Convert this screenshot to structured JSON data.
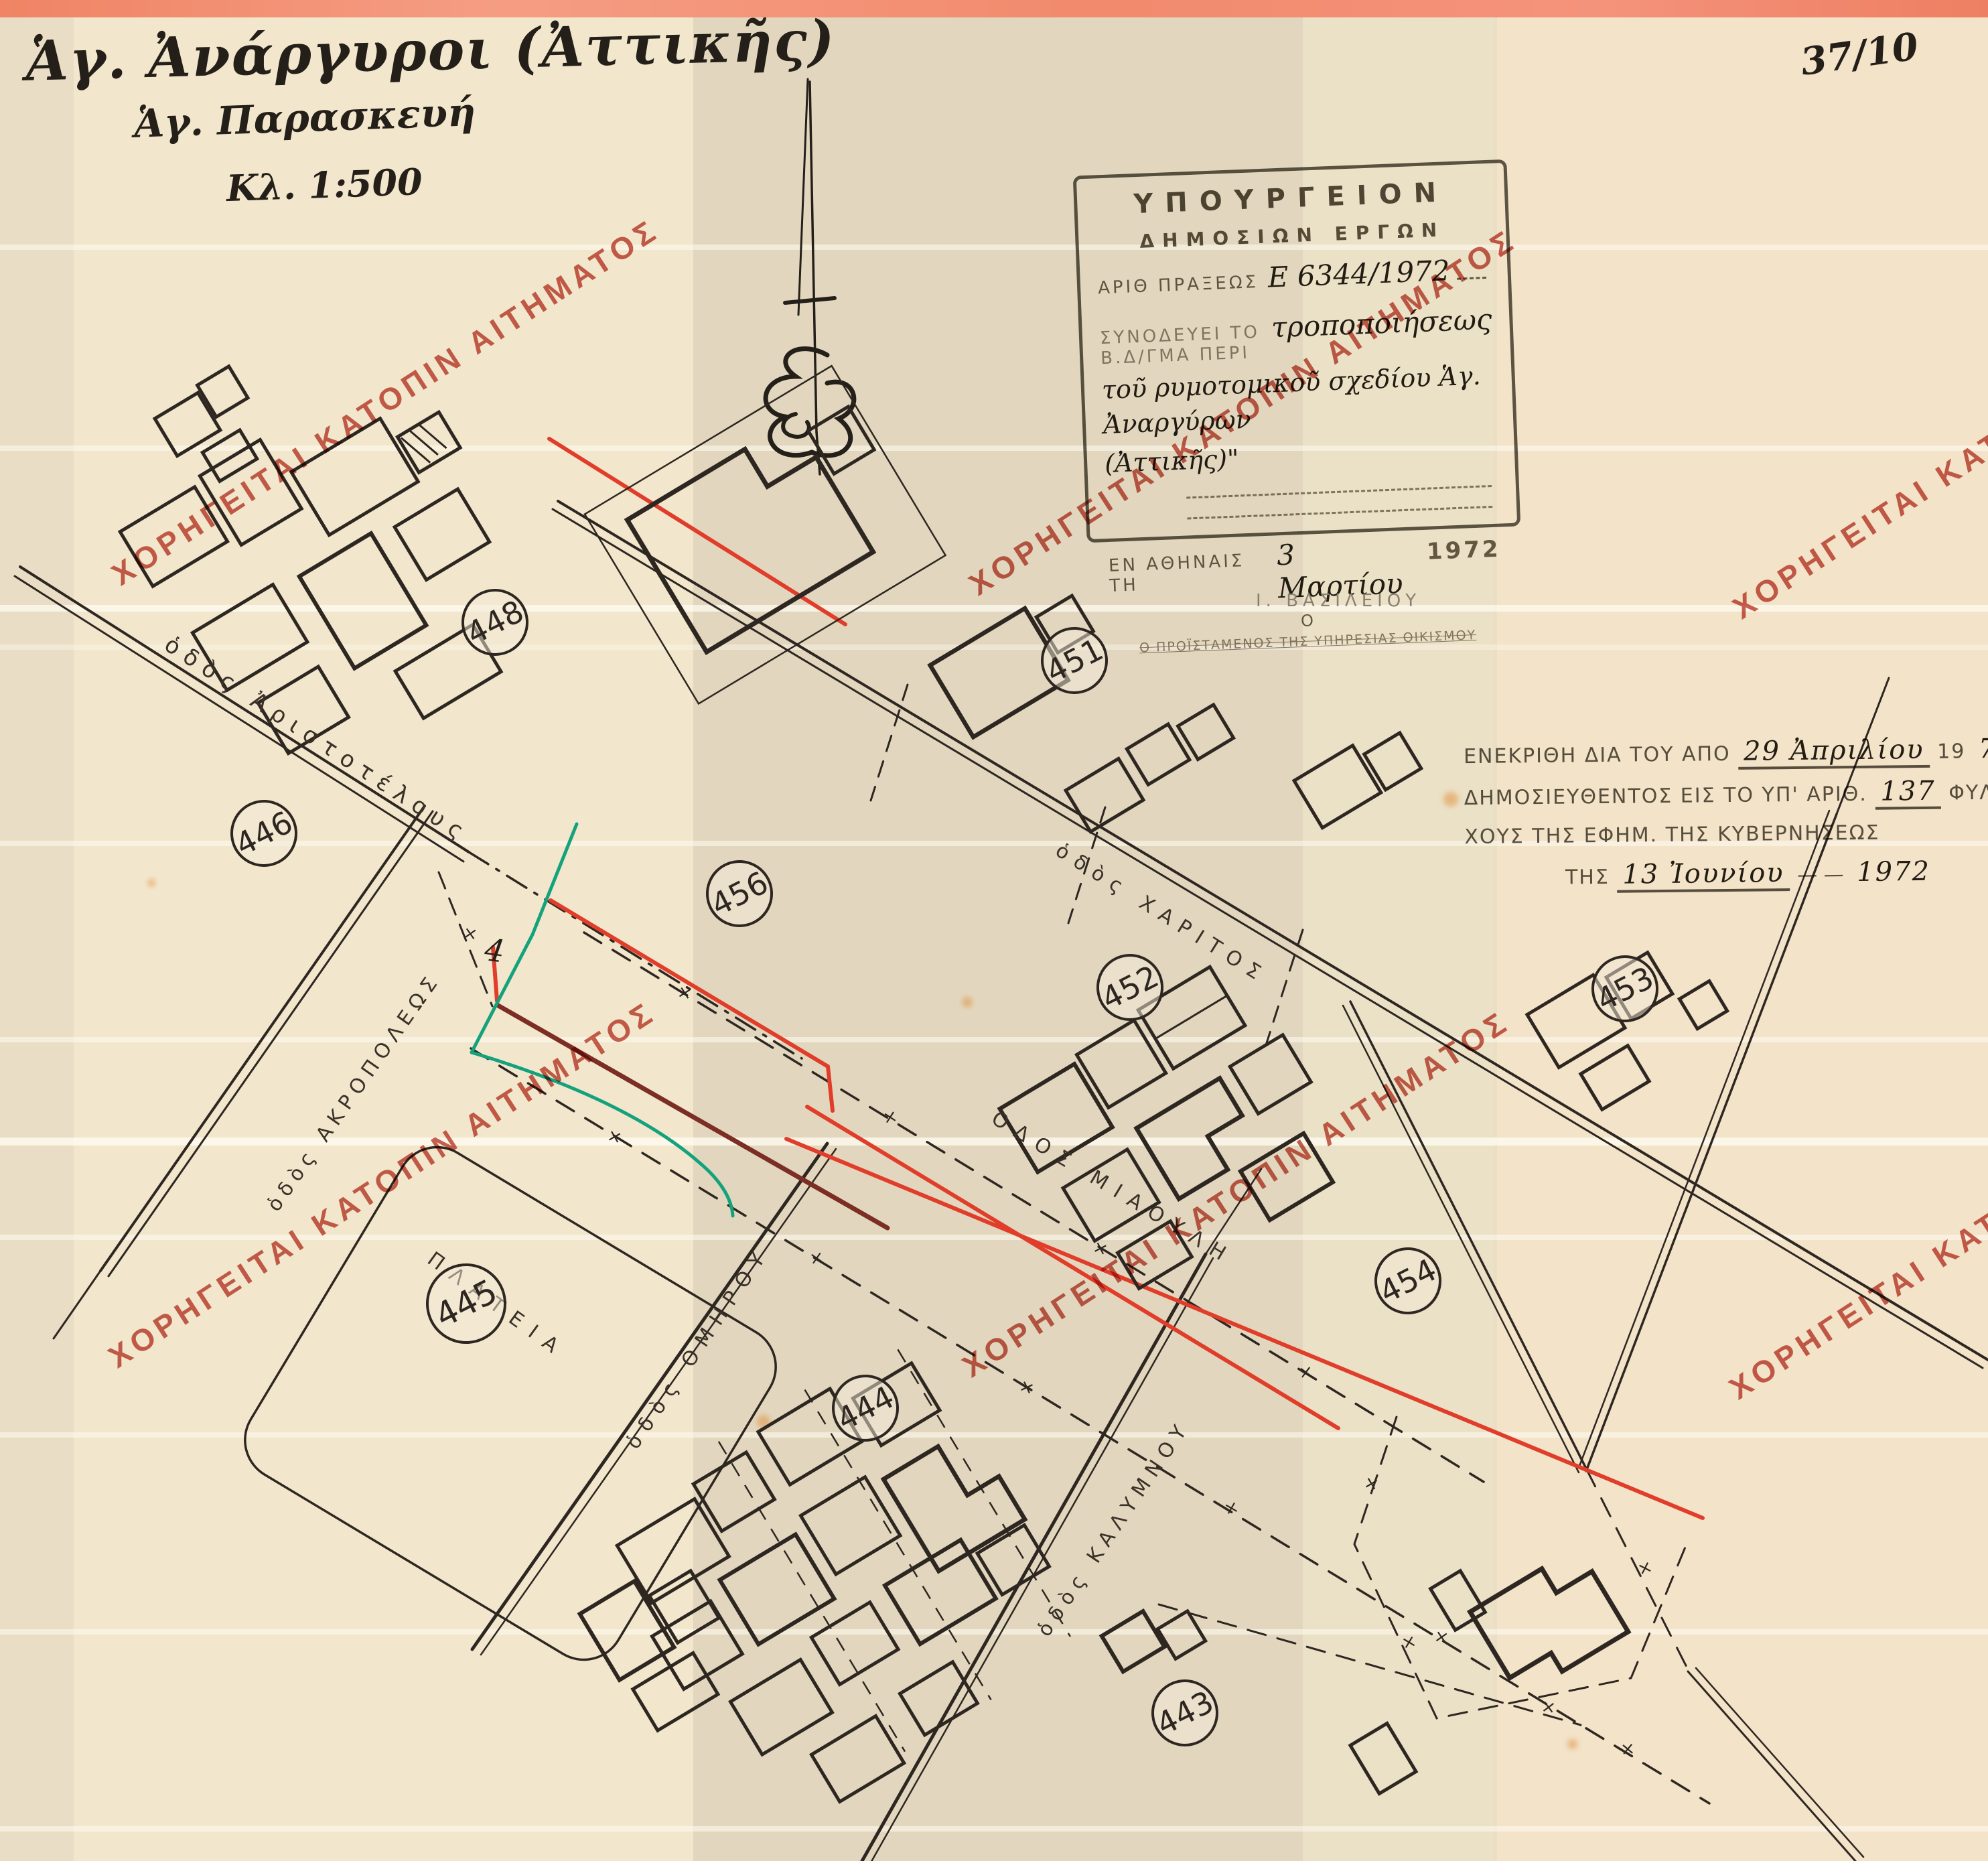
{
  "page": {
    "sheet_number": "37/10"
  },
  "title_block": {
    "line1": "Ἁγ. Ἀνάργυροι (Ἀττικῆς)",
    "line2": "Ἁγ. Παρασκευή",
    "line3": "Κλ. 1:500"
  },
  "watermark": {
    "text": "ΧΟΡΗΓΕΙΤΑΙ ΚΑΤΟΠΙΝ ΑΙΤΗΜΑΤΟΣ",
    "color": "#bf4638"
  },
  "ministry_stamp": {
    "line1": "ΥΠΟΥΡΓΕΙΟΝ",
    "line2": "ΔΗΜΟΣΙΩΝ ΕΡΓΩΝ",
    "act_label": "ΑΡΙΘ ΠΡΑΞΕΩΣ",
    "act_value": "Ε 6344/1972",
    "accompanies_label": "ΣΥΝΟΔΕΥΕΙ ΤΟ Β.Δ/ΓΜΑ ΠΕΡΙ",
    "subject_hw1": "τροποποιήσεως",
    "subject_hw2": "τοῦ ρυμοτομικοῦ σχεδίου Ἁγ. Ἀναργύρων",
    "subject_hw3": "(Ἀττικῆς)\"",
    "place_label": "ΕΝ ΑΘΗΝΑΙΣ ΤΗ",
    "date_value": "3 Μαρτίου",
    "year_value": "1972",
    "o_label": "Ο",
    "signer_label": "Ο ΠΡΟΪΣΤΑΜΕΝΟΣ ΤΗΣ ΥΠΗΡΕΣΙΑΣ ΟΙΚΙΣΜΟΥ"
  },
  "approval_stamp": {
    "line1_a": "ΕΝΕΚΡΙΘΗ ΔΙΑ ΤΟΥ ΑΠΟ",
    "line1_hw": "29 Ἀπριλίου",
    "line1_b": "19",
    "line1_hw2": "72",
    "line1_c": "ΔΙΑΤΑΓΜΑΤΟΣ",
    "line2_a": "ΔΗΜΟΣΙΕΥΘΕΝΤΟΣ ΕΙΣ ΤΟ ΥΠ' ΑΡΙΘ.",
    "line2_hw": "137",
    "line2_b": "ΦΥΛΛΟΝ ΤΟΥ Δ' ΤΕΥ",
    "line3": "ΧΟΥΣ ΤΗΣ ΕΦΗΜ. ΤΗΣ ΚΥΒΕΡΝΗΣΕΩΣ",
    "line4_a": "ΤΗΣ",
    "line4_hw": "13 Ἰουνίου",
    "line4_b": "1972"
  },
  "surveyor_stamp": "Ι. ΒΑΣΙΛΕΙΟΥ",
  "map": {
    "square_label": "ΠΛΑΤΕΙΑ",
    "annotation": "4",
    "blocks": [
      {
        "label": "448"
      },
      {
        "label": "451"
      },
      {
        "label": "446"
      },
      {
        "label": "456"
      },
      {
        "label": "452"
      },
      {
        "label": "453"
      },
      {
        "label": "445"
      },
      {
        "label": "454"
      },
      {
        "label": "444"
      },
      {
        "label": "443"
      }
    ],
    "streets": [
      {
        "label": "ὁδὸς Ἀριστοτέλους"
      },
      {
        "label": "ὁδὸς ΑΚΡΟΠΟΛΕΩΣ"
      },
      {
        "label": "ὁδὸς ΟΜΗΡΟΥ"
      },
      {
        "label": "ὁδὸς ΚΑΛΥΜΝΟΥ"
      },
      {
        "label": "ΟΔΟΣ ΜΙΑΟΥΛΗ"
      },
      {
        "label": "ὁδὸς ΧΑΡΙΤΟΣ"
      }
    ]
  }
}
